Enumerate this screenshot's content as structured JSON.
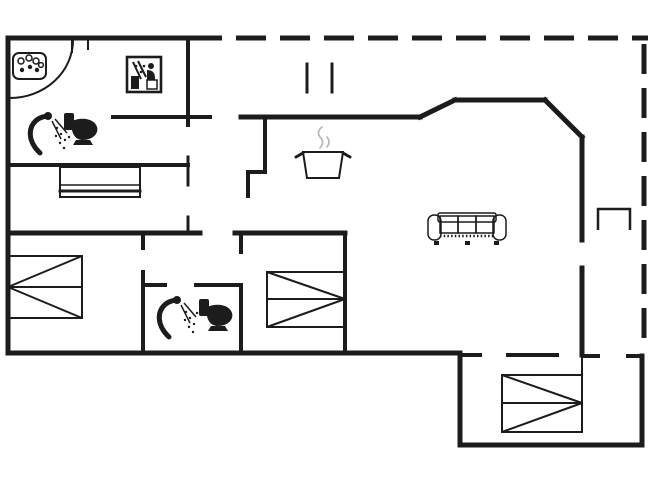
{
  "palette": {
    "background": "#ffffff",
    "line": "#1c1c1c",
    "steam": "#b5b5b5"
  },
  "plan": {
    "kind": "floor-plan",
    "text_labels": [],
    "boundary": {
      "solid_walls": "left, top-left, bottom and bottom-right extension",
      "dashed_walls": "top edge and right edge (open terrace boundary)"
    },
    "icons": [
      {
        "name": "whirlpool-icon",
        "area": "top-left bathroom"
      },
      {
        "name": "sauna-icon",
        "area": "top-left bathroom"
      },
      {
        "name": "shower-icon",
        "area": "top-left bathroom"
      },
      {
        "name": "toilet-icon",
        "area": "top-left bathroom"
      },
      {
        "name": "wardrobe",
        "area": "hall room"
      },
      {
        "name": "terrace-door-marks",
        "area": "terrace"
      },
      {
        "name": "cooking-pot-icon",
        "area": "kitchen"
      },
      {
        "name": "sofa-icon",
        "area": "living room"
      },
      {
        "name": "fireplace-niche",
        "area": "right terrace edge"
      },
      {
        "name": "double-bed",
        "area": "left bedroom"
      },
      {
        "name": "double-bed",
        "area": "middle bedroom"
      },
      {
        "name": "shower-icon",
        "area": "second bathroom"
      },
      {
        "name": "toilet-icon",
        "area": "second bathroom"
      },
      {
        "name": "double-bed",
        "area": "bottom-right bedroom"
      },
      {
        "name": "door-swing-arc",
        "area": "top-left entrance"
      }
    ]
  }
}
